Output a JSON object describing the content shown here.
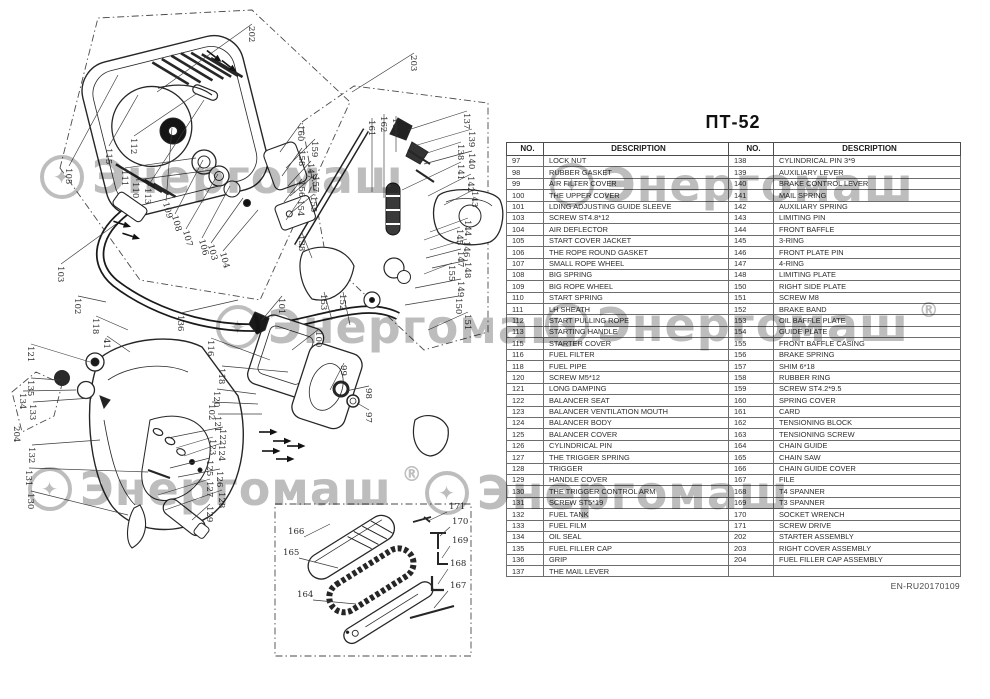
{
  "document": {
    "title": "ПТ-52",
    "footer_code": "EN-RU20170109"
  },
  "table": {
    "headers": {
      "no": "NO.",
      "description": "DESCRIPTION"
    },
    "rows": [
      {
        "l_no": "97",
        "l_desc": "LOCK NUT",
        "r_no": "138",
        "r_desc": "CYLINDRICAL PIN 3*9"
      },
      {
        "l_no": "98",
        "l_desc": "RUBBER GASKET",
        "r_no": "139",
        "r_desc": "AUXILIARY LEVER"
      },
      {
        "l_no": "99",
        "l_desc": "AIR FILTER COVER",
        "r_no": "140",
        "r_desc": "BRAKE CONTROL LEVER"
      },
      {
        "l_no": "100",
        "l_desc": "THE UPPER COVER",
        "r_no": "141",
        "r_desc": "MAIL SPRING"
      },
      {
        "l_no": "101",
        "l_desc": "LDING ADJUSTING GUIDE SLEEVE",
        "r_no": "142",
        "r_desc": "AUXILIARY SPRING"
      },
      {
        "l_no": "103",
        "l_desc": "SCREW ST4.8*12",
        "r_no": "143",
        "r_desc": "LIMITING PIN"
      },
      {
        "l_no": "104",
        "l_desc": "AIR DEFLECTOR",
        "r_no": "144",
        "r_desc": "FRONT BAFFLE"
      },
      {
        "l_no": "105",
        "l_desc": "START COVER JACKET",
        "r_no": "145",
        "r_desc": "3-RING"
      },
      {
        "l_no": "106",
        "l_desc": "THE ROPE ROUND GASKET",
        "r_no": "146",
        "r_desc": "FRONT PLATE PIN"
      },
      {
        "l_no": "107",
        "l_desc": "SMALL ROPE WHEEL",
        "r_no": "147",
        "r_desc": "4-RING"
      },
      {
        "l_no": "108",
        "l_desc": "BIG SPRING",
        "r_no": "148",
        "r_desc": "LIMITING PLATE"
      },
      {
        "l_no": "109",
        "l_desc": "BIG ROPE WHEEL",
        "r_no": "150",
        "r_desc": "RIGHT SIDE PLATE"
      },
      {
        "l_no": "110",
        "l_desc": "START SPRING",
        "r_no": "151",
        "r_desc": "SCREW M8"
      },
      {
        "l_no": "111",
        "l_desc": "LH SHEATH",
        "r_no": "152",
        "r_desc": "BRAKE BAND"
      },
      {
        "l_no": "112",
        "l_desc": "START PULLING ROPE",
        "r_no": "153",
        "r_desc": "OIL BAFFLE PLATE"
      },
      {
        "l_no": "113",
        "l_desc": "STARTING HANDLE",
        "r_no": "154",
        "r_desc": "GUIDE PLATE"
      },
      {
        "l_no": "115",
        "l_desc": "STARTER COVER",
        "r_no": "155",
        "r_desc": "FRONT BAFFLE CASING"
      },
      {
        "l_no": "116",
        "l_desc": "FUEL FILTER",
        "r_no": "156",
        "r_desc": "BRAKE SPRING"
      },
      {
        "l_no": "118",
        "l_desc": "FUEL PIPE",
        "r_no": "157",
        "r_desc": "SHIM 6*18"
      },
      {
        "l_no": "120",
        "l_desc": "SCREW M5*12",
        "r_no": "158",
        "r_desc": "RUBBER RING"
      },
      {
        "l_no": "121",
        "l_desc": "LONG DAMPING",
        "r_no": "159",
        "r_desc": "SCREW ST4.2*9.5"
      },
      {
        "l_no": "122",
        "l_desc": "BALANCER SEAT",
        "r_no": "160",
        "r_desc": "SPRING COVER"
      },
      {
        "l_no": "123",
        "l_desc": "BALANCER VENTILATION MOUTH",
        "r_no": "161",
        "r_desc": "CARD"
      },
      {
        "l_no": "124",
        "l_desc": "BALANCER BODY",
        "r_no": "162",
        "r_desc": "TENSIONING BLOCK"
      },
      {
        "l_no": "125",
        "l_desc": "BALANCER COVER",
        "r_no": "163",
        "r_desc": "TENSIONING SCREW"
      },
      {
        "l_no": "126",
        "l_desc": "CYLINDRICAL PIN",
        "r_no": "164",
        "r_desc": "CHAIN GUIDE"
      },
      {
        "l_no": "127",
        "l_desc": "THE TRIGGER SPRING",
        "r_no": "165",
        "r_desc": "CHAIN SAW"
      },
      {
        "l_no": "128",
        "l_desc": "TRIGGER",
        "r_no": "166",
        "r_desc": "CHAIN GUIDE COVER"
      },
      {
        "l_no": "129",
        "l_desc": "HANDLE COVER",
        "r_no": "167",
        "r_desc": "FILE"
      },
      {
        "l_no": "130",
        "l_desc": "THE TRIGGER CONTROL ARM",
        "r_no": "168",
        "r_desc": "T4 SPANNER"
      },
      {
        "l_no": "131",
        "l_desc": "SCREW ST5*19",
        "r_no": "169",
        "r_desc": "T3 SPANNER"
      },
      {
        "l_no": "132",
        "l_desc": "FUEL TANK",
        "r_no": "170",
        "r_desc": "SOCKET WRENCH"
      },
      {
        "l_no": "133",
        "l_desc": "FUEL FILM",
        "r_no": "171",
        "r_desc": "SCREW DRIVE"
      },
      {
        "l_no": "134",
        "l_desc": "OIL SEAL",
        "r_no": "202",
        "r_desc": "STARTER ASSEMBLY"
      },
      {
        "l_no": "135",
        "l_desc": "FUEL FILLER CAP",
        "r_no": "203",
        "r_desc": "RIGHT COVER ASSEMBLY"
      },
      {
        "l_no": "136",
        "l_desc": "GRIP",
        "r_no": "204",
        "r_desc": "FUEL FILLER CAP ASSEMBLY"
      },
      {
        "l_no": "137",
        "l_desc": "THE MAIL LEVER",
        "r_no": "",
        "r_desc": ""
      }
    ]
  },
  "watermark": {
    "text": "Энергомаш",
    "registered_mark": "®",
    "logo_glyph": "✦",
    "instances": [
      {
        "x": 40,
        "y": 150,
        "logo": true,
        "reg": false
      },
      {
        "x": 550,
        "y": 158,
        "logo": true,
        "reg": false
      },
      {
        "x": 216,
        "y": 300,
        "logo": true,
        "reg": false
      },
      {
        "x": 545,
        "y": 298,
        "logo": true,
        "reg": true
      },
      {
        "x": 28,
        "y": 462,
        "logo": true,
        "reg": true
      },
      {
        "x": 425,
        "y": 466,
        "logo": true,
        "reg": false
      }
    ]
  },
  "diagram": {
    "callout_format": "[number, x, y, rotation_deg, leader_x, leader_y]",
    "callouts": [
      [
        "202",
        249,
        26,
        90,
        157,
        92
      ],
      [
        "203",
        411,
        55,
        90,
        352,
        92
      ],
      [
        "105",
        66,
        168,
        90,
        118,
        75
      ],
      [
        "115",
        106,
        148,
        90,
        138,
        95
      ],
      [
        "112",
        131,
        138,
        90,
        196,
        94
      ],
      [
        "111",
        122,
        170,
        90,
        196,
        158
      ],
      [
        "110",
        133,
        182,
        90,
        212,
        170
      ],
      [
        "113",
        145,
        188,
        90,
        204,
        100
      ],
      [
        "109",
        163,
        203,
        75,
        172,
        128
      ],
      [
        "108",
        172,
        216,
        75,
        203,
        160
      ],
      [
        "107",
        183,
        231,
        75,
        218,
        174
      ],
      [
        "106",
        199,
        240,
        75,
        230,
        186
      ],
      [
        "103",
        208,
        245,
        75,
        243,
        198
      ],
      [
        "104",
        220,
        253,
        75,
        258,
        210
      ],
      [
        "103",
        58,
        266,
        90,
        116,
        224
      ],
      [
        "102",
        75,
        298,
        90,
        106,
        302
      ],
      [
        "118",
        93,
        318,
        90,
        128,
        330
      ],
      [
        "41",
        104,
        338,
        90,
        130,
        352
      ],
      [
        "136",
        178,
        315,
        90,
        238,
        300
      ],
      [
        "116",
        208,
        340,
        90,
        270,
        360
      ],
      [
        "118",
        219,
        368,
        90,
        288,
        372
      ],
      [
        "120",
        214,
        391,
        90,
        256,
        394
      ],
      [
        "102",
        209,
        404,
        90,
        258,
        404
      ],
      [
        "121",
        215,
        416,
        90,
        262,
        414
      ],
      [
        "122",
        220,
        429,
        90,
        168,
        438
      ],
      [
        "123",
        210,
        439,
        90,
        176,
        448
      ],
      [
        "124",
        219,
        445,
        90,
        184,
        456
      ],
      [
        "125",
        207,
        460,
        90,
        170,
        468
      ],
      [
        "126",
        217,
        471,
        90,
        178,
        477
      ],
      [
        "127",
        207,
        481,
        90,
        158,
        495
      ],
      [
        "128",
        219,
        492,
        90,
        165,
        510
      ],
      [
        "129",
        207,
        506,
        90,
        192,
        520
      ],
      [
        "121",
        28,
        346,
        90,
        90,
        362
      ],
      [
        "135",
        28,
        380,
        90,
        60,
        380
      ],
      [
        "134",
        20,
        393,
        90,
        76,
        390
      ],
      [
        "133",
        30,
        404,
        90,
        92,
        398
      ],
      [
        "204",
        14,
        426,
        90,
        null,
        null
      ],
      [
        "132",
        29,
        447,
        90,
        100,
        440
      ],
      [
        "131",
        26,
        470,
        90,
        148,
        472
      ],
      [
        "130",
        28,
        493,
        90,
        128,
        515
      ],
      [
        "101",
        279,
        298,
        90,
        262,
        320
      ],
      [
        "100",
        316,
        331,
        90,
        292,
        350
      ],
      [
        "99",
        341,
        365,
        90,
        330,
        390
      ],
      [
        "98",
        366,
        388,
        90,
        346,
        391
      ],
      [
        "97",
        366,
        412,
        90,
        357,
        403
      ],
      [
        "153",
        321,
        294,
        90,
        332,
        320
      ],
      [
        "152",
        340,
        294,
        90,
        350,
        325
      ],
      [
        "160",
        298,
        125,
        90,
        280,
        152
      ],
      [
        "159",
        312,
        141,
        90,
        286,
        168
      ],
      [
        "158",
        299,
        150,
        90,
        282,
        176
      ],
      [
        "147",
        308,
        163,
        90,
        288,
        186
      ],
      [
        "157",
        313,
        176,
        90,
        290,
        196
      ],
      [
        "156",
        299,
        181,
        90,
        284,
        202
      ],
      [
        "155",
        311,
        196,
        90,
        292,
        212
      ],
      [
        "154",
        298,
        200,
        90,
        286,
        220
      ],
      [
        "161",
        369,
        120,
        90,
        372,
        192
      ],
      [
        "162",
        381,
        116,
        90,
        384,
        198
      ],
      [
        "163",
        393,
        118,
        90,
        396,
        152
      ],
      [
        "138",
        299,
        235,
        90,
        312,
        258
      ],
      [
        "137",
        464,
        113,
        90,
        408,
        130
      ],
      [
        "139",
        469,
        131,
        90,
        414,
        146
      ],
      [
        "138",
        458,
        144,
        90,
        418,
        156
      ],
      [
        "140",
        469,
        153,
        90,
        424,
        164
      ],
      [
        "141",
        458,
        164,
        90,
        402,
        190
      ],
      [
        "142",
        468,
        176,
        90,
        428,
        196
      ],
      [
        "143",
        472,
        191,
        90,
        444,
        205
      ],
      [
        "144",
        465,
        220,
        90,
        430,
        232
      ],
      [
        "145",
        457,
        229,
        90,
        424,
        240
      ],
      [
        "146",
        464,
        241,
        90,
        430,
        250
      ],
      [
        "147",
        458,
        251,
        90,
        426,
        258
      ],
      [
        "148",
        465,
        262,
        90,
        432,
        268
      ],
      [
        "155",
        449,
        265,
        90,
        424,
        274
      ],
      [
        "149",
        458,
        281,
        90,
        415,
        288
      ],
      [
        "150",
        456,
        298,
        90,
        405,
        305
      ],
      [
        "151",
        465,
        314,
        90,
        428,
        330
      ],
      [
        "166",
        288,
        534,
        0,
        330,
        524
      ],
      [
        "165",
        283,
        555,
        0,
        338,
        568
      ],
      [
        "164",
        297,
        597,
        0,
        356,
        604
      ],
      [
        "171",
        449,
        509,
        0,
        428,
        521
      ],
      [
        "170",
        452,
        524,
        0,
        440,
        536
      ],
      [
        "169",
        452,
        543,
        0,
        442,
        558
      ],
      [
        "168",
        450,
        566,
        0,
        438,
        584
      ],
      [
        "167",
        450,
        588,
        0,
        434,
        608
      ]
    ],
    "screw_positions": [
      [
        122,
        224,
        18
      ],
      [
        131,
        236,
        18
      ],
      [
        268,
        432,
        0
      ],
      [
        282,
        441,
        0
      ],
      [
        271,
        451,
        0
      ],
      [
        285,
        459,
        0
      ],
      [
        296,
        446,
        0
      ],
      [
        214,
        56,
        38
      ],
      [
        229,
        66,
        38
      ]
    ]
  }
}
